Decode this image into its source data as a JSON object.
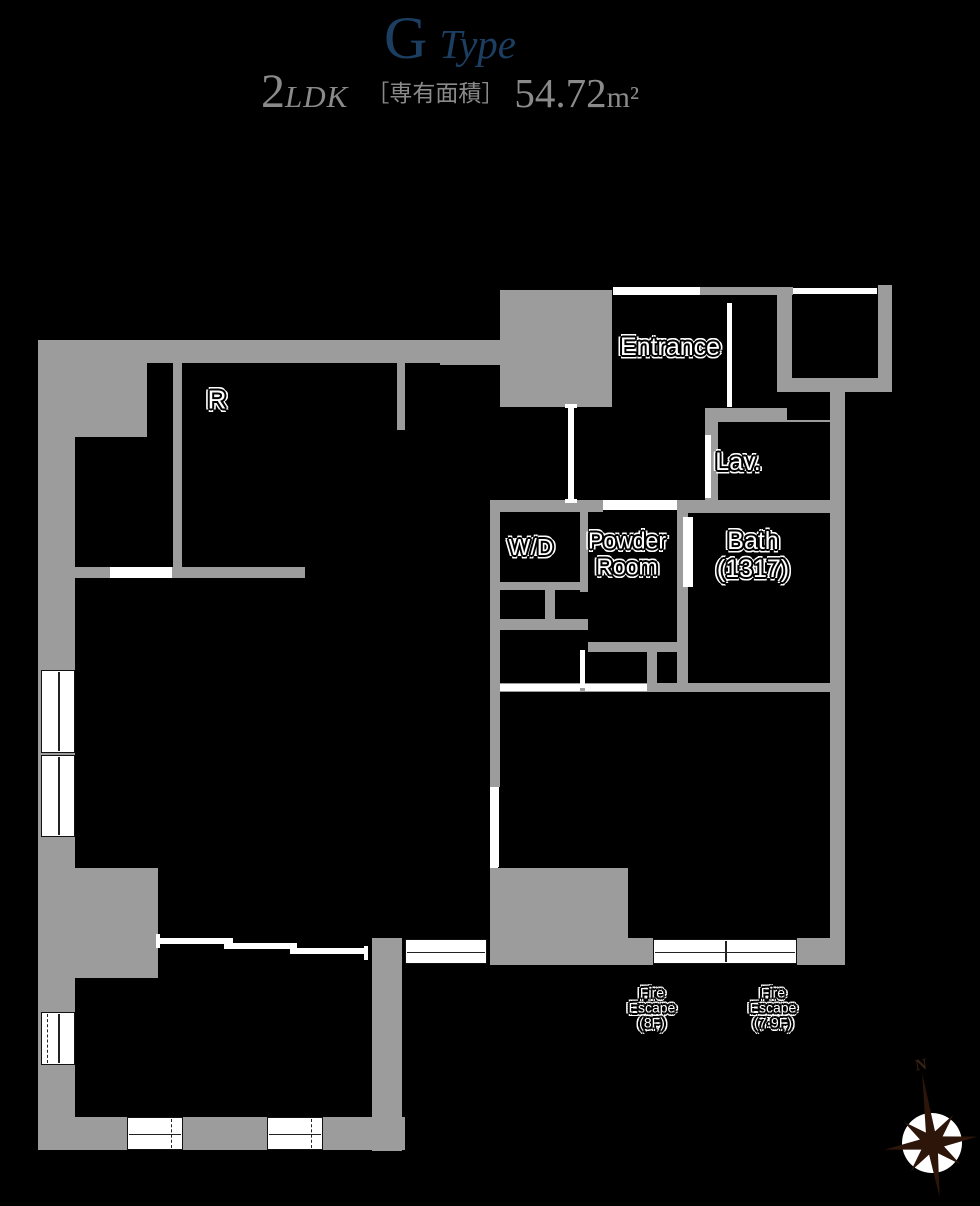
{
  "title": {
    "letter": "G",
    "word": "Type"
  },
  "subtitle": {
    "rooms": "2",
    "ldk": "LDK",
    "bracket": "［専有面積］",
    "area": "54.72",
    "unit": "m²"
  },
  "rooms": {
    "r": "R",
    "entrance": "Entrance",
    "lav": "Lav.",
    "wd": "W/D",
    "powder_line1": "Powder",
    "powder_line2": "Room",
    "bath_line1": "Bath",
    "bath_line2": "(1317)",
    "fire_escape_1_line1": "Fire",
    "fire_escape_1_line2": "Escape",
    "fire_escape_1_line3": "(8F)",
    "fire_escape_2_line1": "Fire",
    "fire_escape_2_line2": "Escape",
    "fire_escape_2_line3": "(7·9F)"
  },
  "compass": {
    "north": "N"
  },
  "colors": {
    "background": "#000000",
    "wall_gray": "#9c9c9c",
    "title_blue": "#1b3e61",
    "subtitle_gray": "#8a8a8a",
    "label_white": "#ffffff",
    "compass_dark": "#2d1509"
  }
}
